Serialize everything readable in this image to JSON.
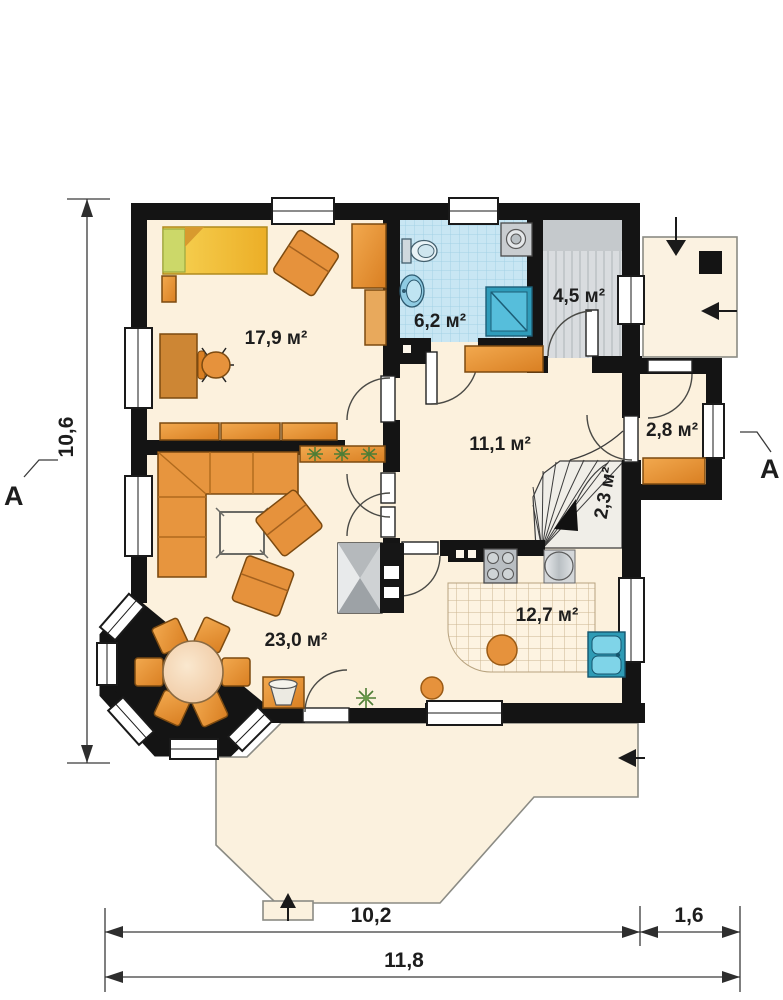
{
  "plan": {
    "section_marker_left": "A",
    "section_marker_right": "A",
    "rooms": {
      "bedroom": {
        "label": "17,9 м²"
      },
      "bathroom": {
        "label": "6,2 м²"
      },
      "pantry": {
        "label": "4,5 м²"
      },
      "hall": {
        "label": "11,1 м²"
      },
      "closet": {
        "label": "2,8 м²"
      },
      "stairs": {
        "label": "2,3 м²"
      },
      "kitchen": {
        "label": "12,7 м²"
      },
      "living": {
        "label": "23,0 м²"
      }
    },
    "dimensions": {
      "left_height": "10,6",
      "bottom_main": "10,2",
      "bottom_porch": "1,6",
      "bottom_total": "11,8"
    },
    "colors": {
      "wall": "#141414",
      "floor_cream": "#fcf1dd",
      "bathroom_tile": "#c8e6f3",
      "pantry_floor": "#d9dcdf",
      "kitchen_tile_line": "#cbb691",
      "furniture_orange": "#e6923c",
      "bed_yellow": "#f3c840",
      "plumbing_blue": "#35aecb",
      "terrace_floor": "#fbf1de"
    }
  }
}
